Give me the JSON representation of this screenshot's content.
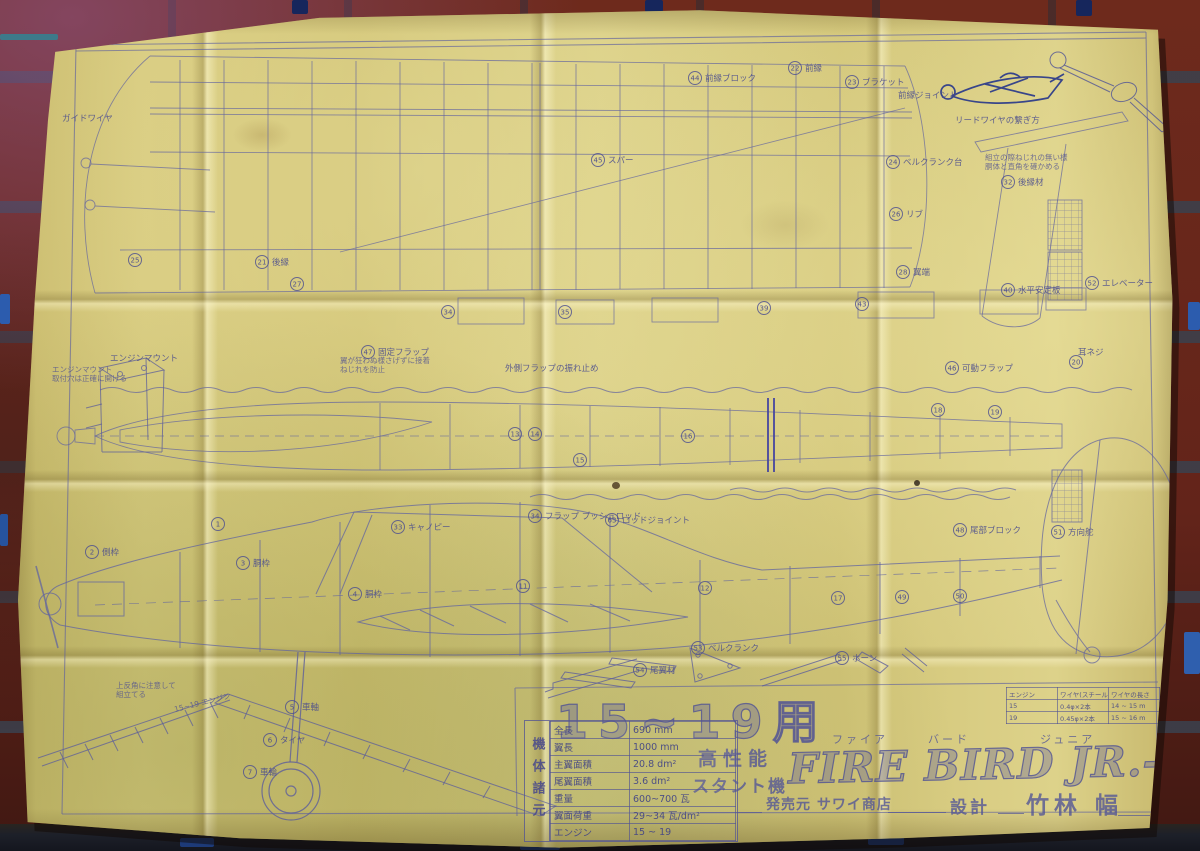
{
  "title_block": {
    "engine_range": "15~19用",
    "furigana": [
      "ファイア",
      "バード",
      "ジュニア"
    ],
    "plane_name": "FIRE BIRD JR.-S",
    "performance": "高性能",
    "type": "スタント機",
    "publisher": "発売元 サワイ商店",
    "design_label": "設計",
    "designer": "竹林 幅"
  },
  "spec_table": {
    "side_label": "機体諸元",
    "rows": [
      [
        "全長",
        "690 mm"
      ],
      [
        "翼長",
        "1000 mm"
      ],
      [
        "主翼面積",
        "20.8 dm²"
      ],
      [
        "尾翼面積",
        "3.6 dm²"
      ],
      [
        "重量",
        "600~700 瓦"
      ],
      [
        "翼面荷重",
        "29~34 瓦/dm²"
      ],
      [
        "エンジン",
        "15 ~ 19"
      ]
    ]
  },
  "wire_table": {
    "rows": [
      [
        "エンジン",
        "ワイヤ(スチール)",
        "ワイヤの長さ"
      ],
      [
        "15",
        "0.4φ×2本",
        "14 ~ 15 m"
      ],
      [
        "19",
        "0.45φ×2本",
        "15 ~ 16 m"
      ]
    ]
  },
  "callouts": [
    {
      "x": 695,
      "y": 78,
      "num": "44",
      "label": "前縁ブロック"
    },
    {
      "x": 795,
      "y": 68,
      "num": "22",
      "label": "前縁"
    },
    {
      "x": 852,
      "y": 82,
      "num": "23",
      "label": "ブラケット"
    },
    {
      "x": 898,
      "y": 95,
      "num": "",
      "label": "前縁ジョイント"
    },
    {
      "x": 368,
      "y": 352,
      "num": "47",
      "label": "固定フラップ"
    },
    {
      "x": 505,
      "y": 368,
      "num": "",
      "label": "外側フラップの振れ止め"
    },
    {
      "x": 952,
      "y": 368,
      "num": "46",
      "label": "可動フラップ"
    },
    {
      "x": 398,
      "y": 527,
      "num": "33",
      "label": "キャノピー"
    },
    {
      "x": 535,
      "y": 516,
      "num": "34",
      "label": "フラップ プッシュロッド"
    },
    {
      "x": 612,
      "y": 520,
      "num": "63",
      "label": "ロッドジョイント"
    },
    {
      "x": 355,
      "y": 594,
      "num": "4",
      "label": "胴枠"
    },
    {
      "x": 243,
      "y": 563,
      "num": "3",
      "label": "胴枠"
    },
    {
      "x": 92,
      "y": 552,
      "num": "2",
      "label": "側枠"
    },
    {
      "x": 960,
      "y": 530,
      "num": "48",
      "label": "尾部ブロック"
    },
    {
      "x": 1008,
      "y": 290,
      "num": "40",
      "label": "水平安定板"
    },
    {
      "x": 1092,
      "y": 283,
      "num": "52",
      "label": "エレベーター"
    },
    {
      "x": 1008,
      "y": 182,
      "num": "32",
      "label": "後縁材"
    },
    {
      "x": 893,
      "y": 162,
      "num": "24",
      "label": "ベルクランク台"
    },
    {
      "x": 896,
      "y": 214,
      "num": "26",
      "label": "リブ"
    },
    {
      "x": 903,
      "y": 272,
      "num": "28",
      "label": "翼端"
    },
    {
      "x": 1058,
      "y": 532,
      "num": "51",
      "label": "方向舵"
    },
    {
      "x": 270,
      "y": 740,
      "num": "6",
      "label": "タイヤ"
    },
    {
      "x": 250,
      "y": 772,
      "num": "7",
      "label": "車輪"
    },
    {
      "x": 292,
      "y": 707,
      "num": "5",
      "label": "車軸"
    },
    {
      "x": 955,
      "y": 120,
      "num": "",
      "label": "リードワイヤの繋ぎ方"
    },
    {
      "x": 62,
      "y": 118,
      "num": "",
      "label": "ガイドワイヤ"
    },
    {
      "x": 640,
      "y": 670,
      "num": "54",
      "label": "尾翼材"
    },
    {
      "x": 842,
      "y": 658,
      "num": "55",
      "label": "ホーン"
    },
    {
      "x": 698,
      "y": 648,
      "num": "53",
      "label": "ベルクランク"
    },
    {
      "x": 1078,
      "y": 352,
      "num": "",
      "label": "耳ネジ"
    },
    {
      "x": 598,
      "y": 160,
      "num": "45",
      "label": "スパー"
    },
    {
      "x": 262,
      "y": 262,
      "num": "21",
      "label": "後縁"
    },
    {
      "x": 110,
      "y": 358,
      "num": "",
      "label": "エンジンマウント"
    },
    {
      "x": 515,
      "y": 434,
      "num": "13",
      "label": ""
    },
    {
      "x": 535,
      "y": 434,
      "num": "14",
      "label": ""
    },
    {
      "x": 688,
      "y": 436,
      "num": "16",
      "label": ""
    },
    {
      "x": 580,
      "y": 460,
      "num": "15",
      "label": ""
    },
    {
      "x": 448,
      "y": 312,
      "num": "34",
      "label": ""
    },
    {
      "x": 565,
      "y": 312,
      "num": "35",
      "label": ""
    },
    {
      "x": 764,
      "y": 308,
      "num": "39",
      "label": ""
    },
    {
      "x": 862,
      "y": 304,
      "num": "43",
      "label": ""
    },
    {
      "x": 297,
      "y": 284,
      "num": "27",
      "label": ""
    },
    {
      "x": 135,
      "y": 260,
      "num": "25",
      "label": ""
    },
    {
      "x": 218,
      "y": 524,
      "num": "1",
      "label": ""
    },
    {
      "x": 705,
      "y": 588,
      "num": "12",
      "label": ""
    },
    {
      "x": 523,
      "y": 586,
      "num": "11",
      "label": ""
    },
    {
      "x": 838,
      "y": 598,
      "num": "17",
      "label": ""
    },
    {
      "x": 902,
      "y": 597,
      "num": "49",
      "label": ""
    },
    {
      "x": 960,
      "y": 596,
      "num": "50",
      "label": ""
    },
    {
      "x": 938,
      "y": 410,
      "num": "18",
      "label": ""
    },
    {
      "x": 995,
      "y": 412,
      "num": "19",
      "label": ""
    },
    {
      "x": 1076,
      "y": 362,
      "num": "20",
      "label": ""
    }
  ],
  "notes": [
    {
      "x": 340,
      "y": 363,
      "rot": 0,
      "lines": [
        "翼が狂わぬ様さげずに接着",
        "ねじれを防止"
      ]
    },
    {
      "x": 985,
      "y": 160,
      "rot": 0,
      "lines": [
        "組立の際ねじれの無い様",
        "胴体と直角を確かめる"
      ]
    },
    {
      "x": 52,
      "y": 372,
      "rot": 0,
      "lines": [
        "エンジンマウント",
        "取付穴は正確に開ける"
      ]
    },
    {
      "x": 116,
      "y": 688,
      "rot": 0,
      "lines": [
        "上反角に注意して",
        "組立てる"
      ]
    },
    {
      "x": 175,
      "y": 712,
      "rot": -14,
      "lines": [
        "15~19 エンジン"
      ]
    }
  ],
  "colors": {
    "paper": "#d2c578",
    "blueprint_line": "#6a6ca6",
    "dark_ink": "#38458a",
    "brick": "#6b2619",
    "mortar": "#3a414e",
    "accent_blue": "#2c5cae"
  }
}
